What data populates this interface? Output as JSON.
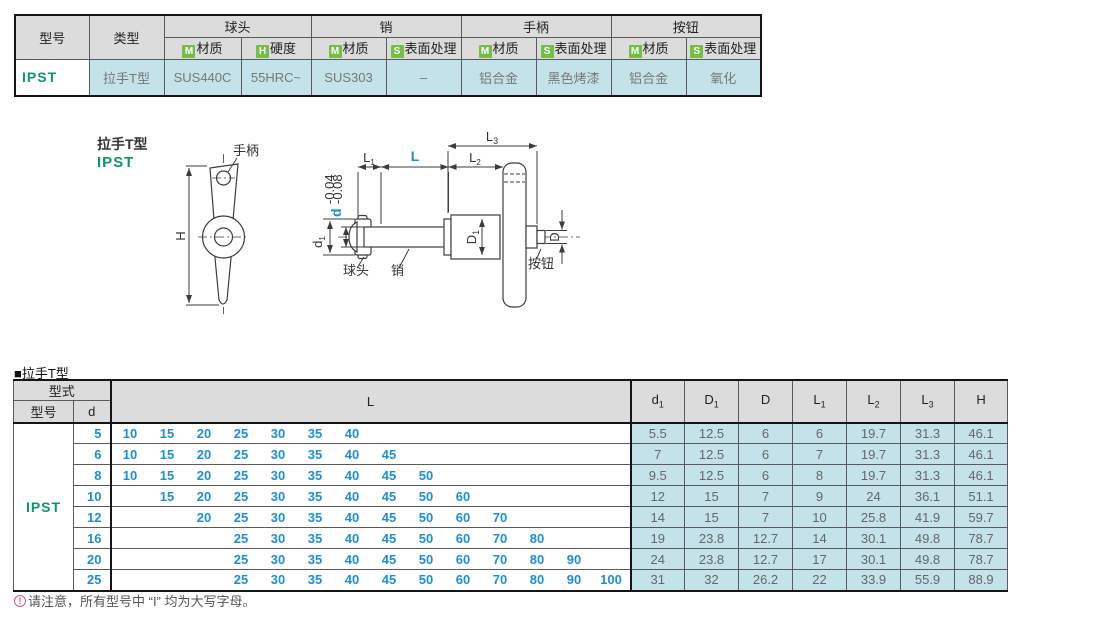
{
  "accent_colors": {
    "model_green": "#0a9673",
    "value_blue": "#1c8fd6",
    "badge_green": "#72bf44",
    "cell_blue": "#c3e2ea",
    "header_gray": "#dcdcdc",
    "note_pink": "#e0507e"
  },
  "spec_table": {
    "headers": {
      "model": "型号",
      "type": "类型",
      "groups": [
        {
          "label": "球头",
          "subs": [
            {
              "badge": "M",
              "label": "材质"
            },
            {
              "badge": "H",
              "label": "硬度"
            }
          ]
        },
        {
          "label": "销",
          "subs": [
            {
              "badge": "M",
              "label": "材质"
            },
            {
              "badge": "S",
              "label": "表面处理"
            }
          ]
        },
        {
          "label": "手柄",
          "subs": [
            {
              "badge": "M",
              "label": "材质"
            },
            {
              "badge": "S",
              "label": "表面处理"
            }
          ]
        },
        {
          "label": "按钮",
          "subs": [
            {
              "badge": "M",
              "label": "材质"
            },
            {
              "badge": "S",
              "label": "表面处理"
            }
          ]
        }
      ]
    },
    "row": {
      "model": "IPST",
      "type": "拉手T型",
      "values": [
        "SUS440C",
        "55HRC~",
        "SUS303",
        "–",
        "铝合金",
        "黑色烤漆",
        "铝合金",
        "氧化"
      ]
    }
  },
  "diagram": {
    "title": "拉手T型",
    "model": "IPST",
    "labels": {
      "handle": "手柄",
      "ball": "球头",
      "pin": "销",
      "button": "按钮",
      "H": "H",
      "L": "L",
      "L1": {
        "base": "L",
        "sub": "1"
      },
      "L2": {
        "base": "L",
        "sub": "2"
      },
      "L3": {
        "base": "L",
        "sub": "3"
      },
      "d": "d",
      "d_tol_upper": "-0.04",
      "d_tol_lower": "-0.08",
      "d1": {
        "base": "d",
        "sub": "1"
      },
      "D1": {
        "base": "D",
        "sub": "1"
      },
      "D": "D"
    }
  },
  "dim_table": {
    "caption": "■拉手T型",
    "header": {
      "type_group": "型式",
      "model": "型号",
      "d": "d",
      "L": "L",
      "dims": [
        {
          "base": "d",
          "sub": "1"
        },
        {
          "base": "D",
          "sub": "1"
        },
        {
          "base": "D",
          "sub": ""
        },
        {
          "base": "L",
          "sub": "1"
        },
        {
          "base": "L",
          "sub": "2"
        },
        {
          "base": "L",
          "sub": "3"
        },
        {
          "base": "H",
          "sub": ""
        }
      ]
    },
    "model": "IPST",
    "l_slots": [
      10,
      15,
      20,
      25,
      30,
      35,
      40,
      45,
      50,
      60,
      70,
      80,
      90,
      100
    ],
    "rows": [
      {
        "d": "5",
        "L": [
          10,
          15,
          20,
          25,
          30,
          35,
          40
        ],
        "dims": [
          "5.5",
          "12.5",
          "6",
          "6",
          "19.7",
          "31.3",
          "46.1"
        ]
      },
      {
        "d": "6",
        "L": [
          10,
          15,
          20,
          25,
          30,
          35,
          40,
          45
        ],
        "dims": [
          "7",
          "12.5",
          "6",
          "7",
          "19.7",
          "31.3",
          "46.1"
        ]
      },
      {
        "d": "8",
        "L": [
          10,
          15,
          20,
          25,
          30,
          35,
          40,
          45,
          50
        ],
        "dims": [
          "9.5",
          "12.5",
          "6",
          "8",
          "19.7",
          "31.3",
          "46.1"
        ]
      },
      {
        "d": "10",
        "L": [
          15,
          20,
          25,
          30,
          35,
          40,
          45,
          50,
          60
        ],
        "dims": [
          "12",
          "15",
          "7",
          "9",
          "24",
          "36.1",
          "51.1"
        ]
      },
      {
        "d": "12",
        "L": [
          20,
          25,
          30,
          35,
          40,
          45,
          50,
          60,
          70
        ],
        "dims": [
          "14",
          "15",
          "7",
          "10",
          "25.8",
          "41.9",
          "59.7"
        ]
      },
      {
        "d": "16",
        "L": [
          25,
          30,
          35,
          40,
          45,
          50,
          60,
          70,
          80
        ],
        "dims": [
          "19",
          "23.8",
          "12.7",
          "14",
          "30.1",
          "49.8",
          "78.7"
        ]
      },
      {
        "d": "20",
        "L": [
          25,
          30,
          35,
          40,
          45,
          50,
          60,
          70,
          80,
          90
        ],
        "dims": [
          "24",
          "23.8",
          "12.7",
          "17",
          "30.1",
          "49.8",
          "78.7"
        ]
      },
      {
        "d": "25",
        "L": [
          25,
          30,
          35,
          40,
          45,
          50,
          60,
          70,
          80,
          90,
          100
        ],
        "dims": [
          "31",
          "32",
          "26.2",
          "22",
          "33.9",
          "55.9",
          "88.9"
        ]
      }
    ]
  },
  "footnote": {
    "icon": "!",
    "text": "请注意，所有型号中 “I” 均为大写字母。"
  }
}
